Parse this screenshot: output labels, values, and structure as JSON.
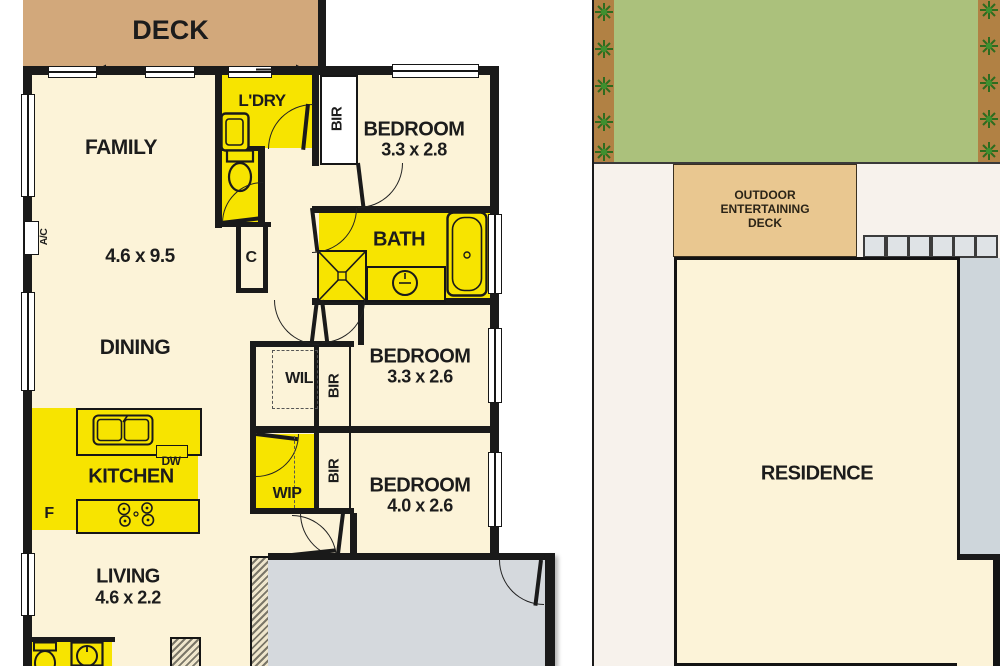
{
  "floorplan": {
    "deck": {
      "line1": "ENTERTAINING",
      "line2": "DECK"
    },
    "rooms": {
      "family": {
        "name": "FAMILY",
        "dims": "4.6 x 9.5"
      },
      "dining": {
        "name": "DINING"
      },
      "kitchen": {
        "name": "KITCHEN"
      },
      "living": {
        "name": "LIVING",
        "dims": "4.6 x 2.2"
      },
      "bedroom1": {
        "name": "BEDROOM",
        "dims": "3.3 x 2.8"
      },
      "bathroom": {
        "name": "BATH"
      },
      "bedroom2": {
        "name": "BEDROOM",
        "dims": "3.3 x 2.6"
      },
      "bedroom3": {
        "name": "BEDROOM",
        "dims": "4.0 x 2.6"
      },
      "laundry": {
        "name": "L'DRY"
      },
      "walk_in_linen": {
        "name": "WIL"
      },
      "walk_in_pantry": {
        "name": "WIP"
      },
      "closet": {
        "name": "C"
      }
    },
    "labels": {
      "fridge": "F",
      "dishwasher": "DW",
      "air_conditioner": "A/C",
      "built_in_robe": "BIR"
    }
  },
  "siteplan": {
    "outdoor_deck": {
      "line1": "OUTDOOR",
      "line2": "ENTERTAINING",
      "line3": "DECK"
    },
    "residence": {
      "name": "RESIDENCE"
    }
  },
  "colors": {
    "floor_cream": "#FCF3D8",
    "wet_area_yellow": "#F7E400",
    "deck_tan": "#D2A87B",
    "site_deck_tan": "#E9C790",
    "lawn_green": "#ABC17C",
    "garden_brown": "#B18144",
    "plant_green": "#3E7D2B",
    "path_offwhite": "#F7F2EC",
    "driveway_gray": "#CED6DB",
    "porch_gray": "#D5D9DD",
    "wall_black": "#1A1A1A"
  }
}
